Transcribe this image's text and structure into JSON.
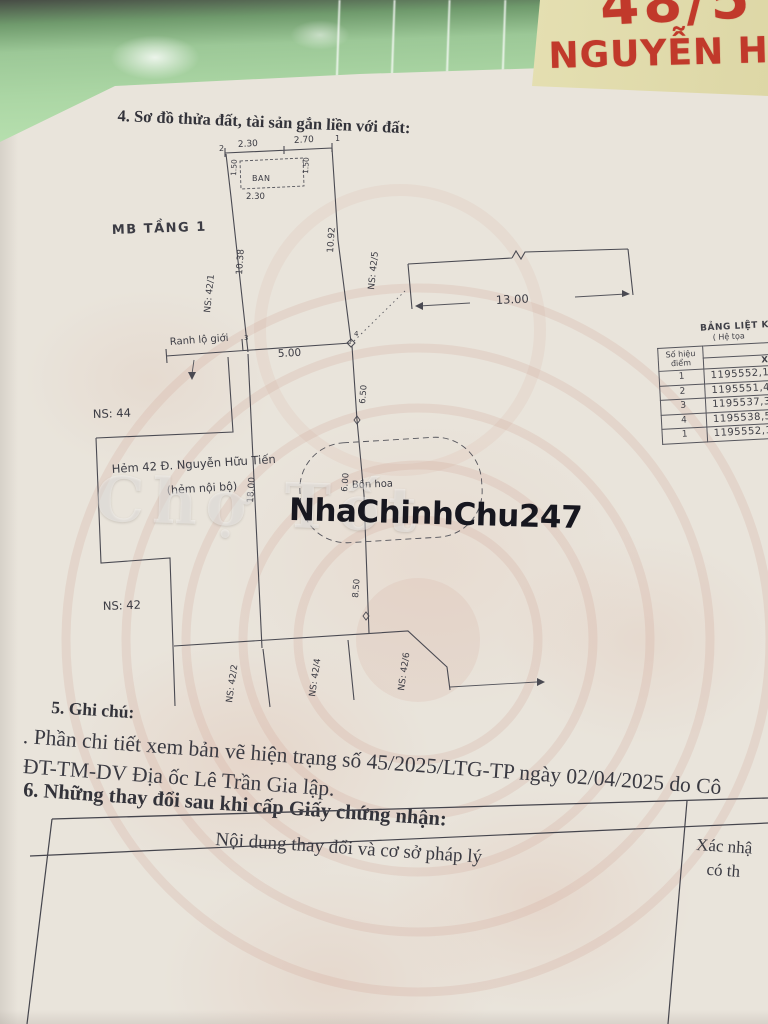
{
  "colors": {
    "binder_green": "#a9d3a3",
    "label_yellow": "#ddd7a6",
    "handwriting_red": "#c1392b",
    "paper": "#e9e4db",
    "ink": "#3a3a42",
    "watermark_ink": "#17171f",
    "emblem_pink": "#d8a38e"
  },
  "binder": {
    "label_line1": "48/5",
    "label_line2": "NGUYỄN H"
  },
  "document": {
    "section4_title": "4. Sơ đồ thửa đất, tài sản gắn liền với đất:",
    "ghost_watermark": "Chợ Tốt",
    "watermark": "NhaChinhChu247",
    "section5_title": "5. Ghi chú:",
    "note_line1": ". Phần chi tiết xem bản vẽ hiện trạng số 45/2025/LTG-TP ngày 02/04/2025 do Cô",
    "note_line2": "ĐT-TM-DV Địa ốc Lê Trần Gia lập.",
    "section6_title": "6. Những thay đổi sau khi cấp Giấy chứng nhận:",
    "changes_table": {
      "col1_header": "Nội dung thay đổi và cơ sở pháp lý",
      "col2_header_line1": "Xác nhậ",
      "col2_header_line2": "có th"
    }
  },
  "diagram": {
    "floor_label": "MB TẦNG 1",
    "labels": {
      "point_2": "2",
      "point_1": "1",
      "point_3": "3",
      "point_4": "4",
      "dim_top_left": "2.30",
      "dim_top_right": "2.70",
      "balcony": "BAN",
      "dim_balcony_width": "2.30",
      "dim_balcony_depth_left": "1.50",
      "dim_balcony_depth_right": "1.50",
      "dim_left_side": "10.38",
      "dim_right_side": "10.92",
      "ns_42_1": "NS: 42/1",
      "ns_42_5": "NS: 42/5",
      "ns_44": "NS: 44",
      "ns_42": "NS: 42",
      "ns_42_2": "NS: 42/2",
      "ns_42_4": "NS: 42/4",
      "ns_42_6": "NS: 42/6",
      "ranh_lo_gioi": "Ranh lộ giới",
      "dim_front": "5.00",
      "dim_13": "13.00",
      "dim_6_5": "6.50",
      "dim_6": "6.00",
      "dim_8_5": "8.50",
      "dim_18": "18.00",
      "street_line1": "Hẻm 42 Đ. Nguyễn Hữu Tiến",
      "street_line2": "(hẻm nội bộ)",
      "bon_hoa": "Bồn hoa"
    },
    "coordinate_table": {
      "title": "BẢNG LIỆT KÊ T",
      "subtitle": "( Hệ tọa",
      "col_point_header": "Số hiệu điểm",
      "col_x_header": "X(m)",
      "rows": [
        {
          "id": "1",
          "x": "1195552,1"
        },
        {
          "id": "2",
          "x": "1195551,4"
        },
        {
          "id": "3",
          "x": "1195537,3"
        },
        {
          "id": "4",
          "x": "1195538,5"
        },
        {
          "id": "1",
          "x": "1195552,1"
        }
      ]
    }
  }
}
